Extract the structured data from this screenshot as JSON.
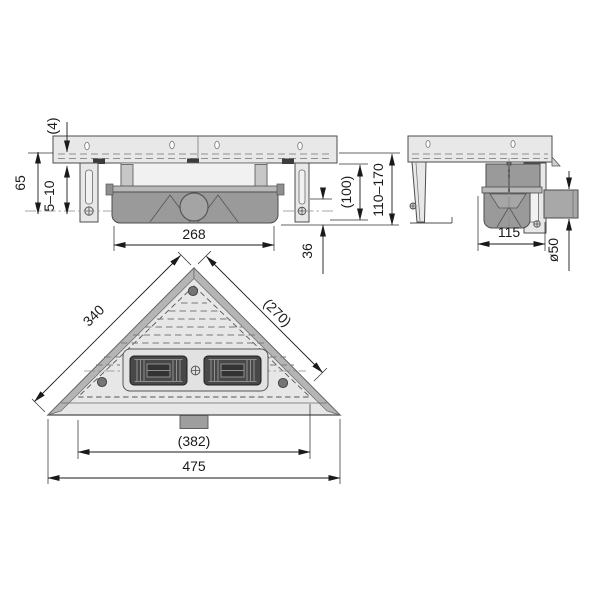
{
  "front_view": {
    "flange_thickness": "(4)",
    "mount_height": "65",
    "wall_gap": "5–10",
    "body_width": "268",
    "trap_depth": "36",
    "min_height": "(100)",
    "height_range": "110–170"
  },
  "side_view": {
    "body_depth": "115",
    "outlet_diameter": "ø50"
  },
  "top_view": {
    "left_edge": "340",
    "right_edge": "(270)",
    "grate_width": "(382)",
    "overall_width": "475"
  },
  "colors": {
    "background": "#ffffff",
    "part_light": "#e8e8e8",
    "part_mid": "#b8b8b8",
    "part_dark": "#9a9a9a",
    "grate_dark": "#484848",
    "outline": "#4d4d4d",
    "dimension": "#1a1a1a"
  }
}
